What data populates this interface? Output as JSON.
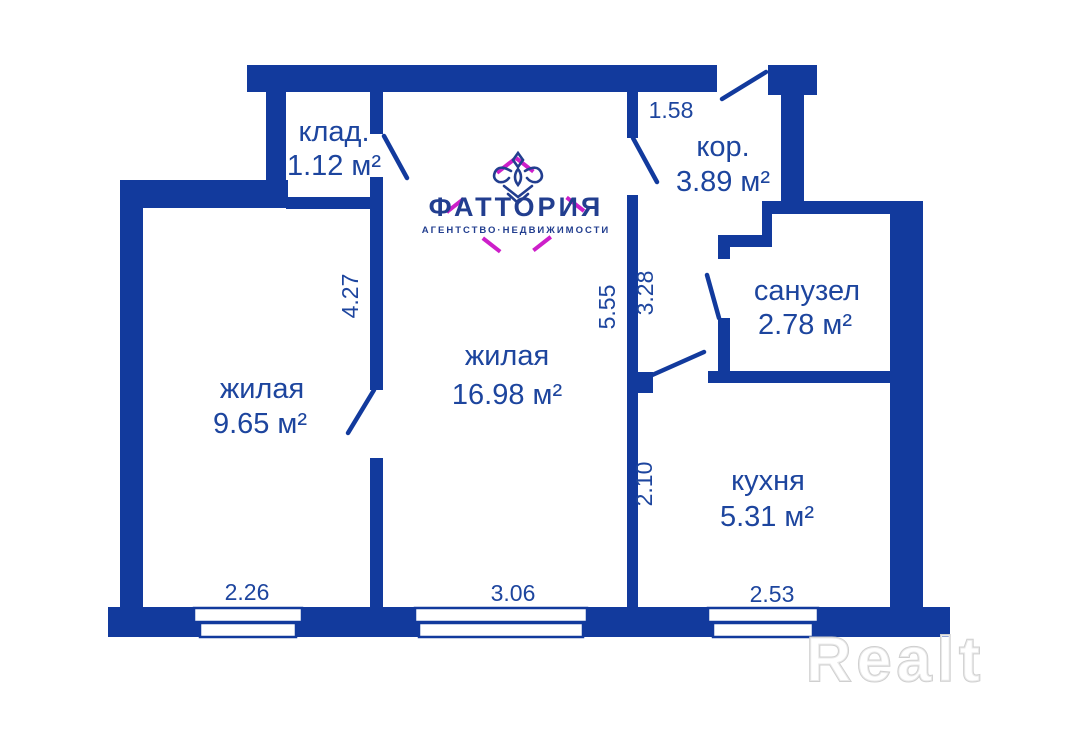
{
  "plan": {
    "rooms": [
      {
        "name": "storage",
        "label": "клад.",
        "area": "1.12 м²"
      },
      {
        "name": "corridor",
        "label": "кор.",
        "area": "3.89 м²"
      },
      {
        "name": "bathroom",
        "label": "санузел",
        "area": "2.78 м²"
      },
      {
        "name": "living_small",
        "label": "жилая",
        "area": "9.65 м²"
      },
      {
        "name": "living_large",
        "label": "жилая",
        "area": "16.98 м²"
      },
      {
        "name": "kitchen",
        "label": "кухня",
        "area": "5.31 м²"
      }
    ],
    "dimensions": {
      "corridor_width": "1.58",
      "living_small_height": "4.27",
      "living_large_height": "5.55",
      "corridor_height": "3.28",
      "kitchen_height": "2.10",
      "living_small_width": "2.26",
      "living_large_width": "3.06",
      "kitchen_width": "2.53"
    }
  },
  "logo": {
    "brand": "ФАТТОРИЯ",
    "tagline": "АГЕНТСТВО·НЕДВИЖИМОСТИ"
  },
  "watermark": {
    "text": "Realt"
  },
  "colors": {
    "wall": "#123A9D",
    "label": "#1D459E",
    "logo_magenta": "#CD1FC9",
    "logo_navy": "#223E8F",
    "watermark_stroke": "#CFCFCF"
  }
}
